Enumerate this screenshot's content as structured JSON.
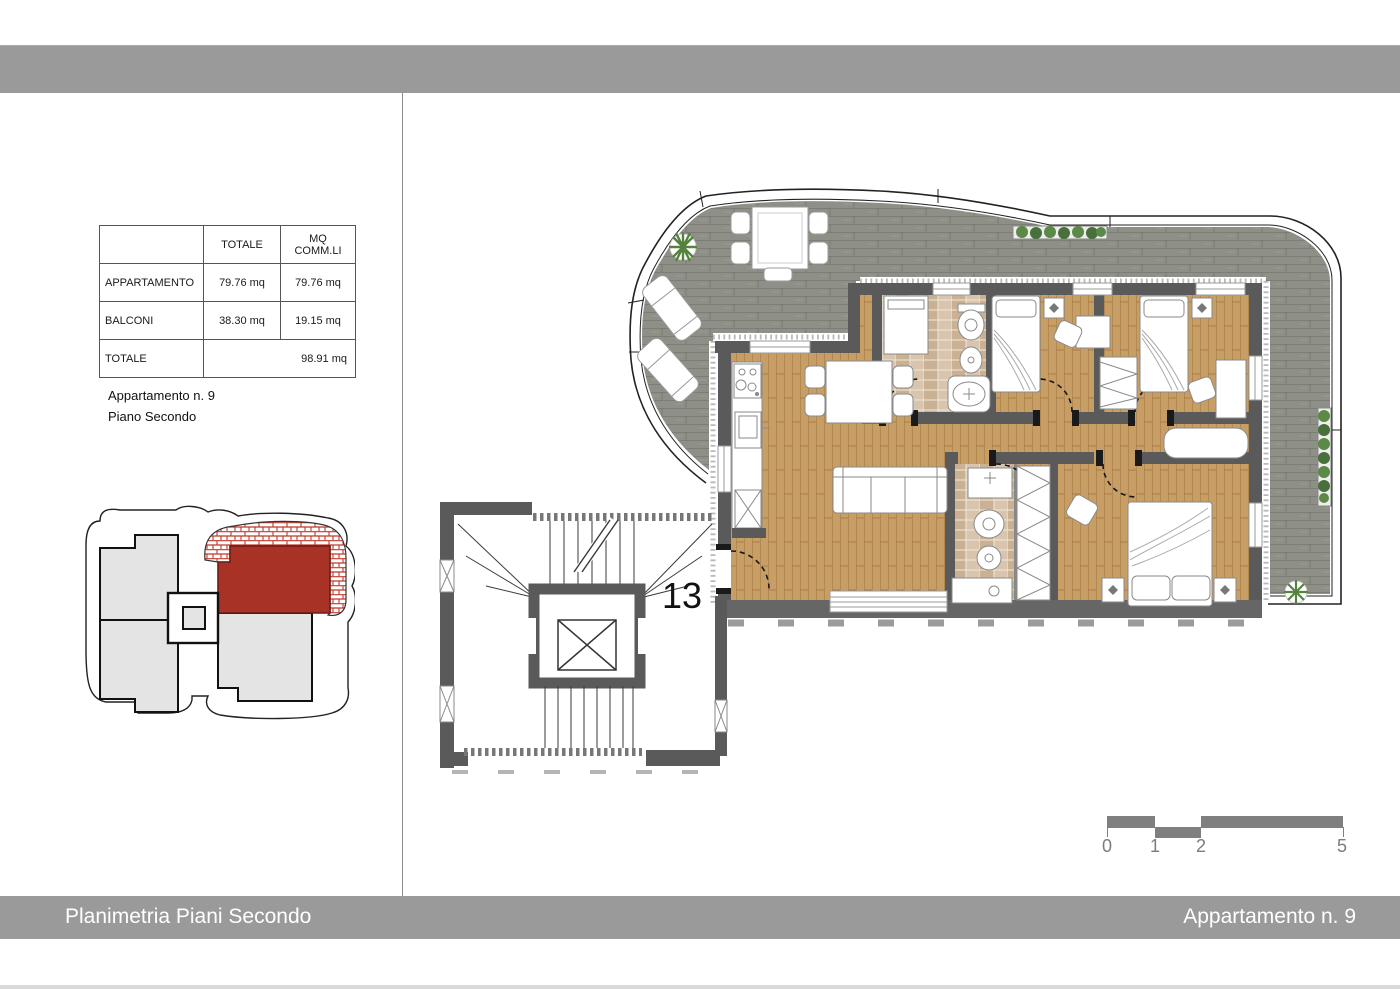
{
  "summary_table": {
    "headers": {
      "col1": "",
      "col2": "TOTALE",
      "col3": "MQ COMM.LI"
    },
    "rows": [
      {
        "label": "APPARTAMENTO",
        "totale": "79.76 mq",
        "mq_commli": "79.76 mq"
      },
      {
        "label": "BALCONI",
        "totale": "38.30 mq",
        "mq_commli": "19.15 mq"
      },
      {
        "label": "TOTALE",
        "totale": "",
        "mq_commli": "98.91 mq"
      }
    ]
  },
  "captions": {
    "apartment": "Appartamento n. 9",
    "floor": "Piano Secondo"
  },
  "floor_plan": {
    "staircase_unit_label": "13"
  },
  "scale_bar": {
    "labels": [
      "0",
      "1",
      "2",
      "5"
    ]
  },
  "footer": {
    "left": "Planimetria Piani Secondo",
    "right": "Appartamento n. 9"
  },
  "colors": {
    "bar_gray": "#9a9a9a",
    "wall_gray": "#5a5a5a",
    "wood_floor": "#c89e67",
    "deck_gray": "#8e9088",
    "tile_beige": "#d9c5ae",
    "highlight_red": "#a93226",
    "scale_gray": "#7f7f7f",
    "plant_green": "#55833f"
  }
}
